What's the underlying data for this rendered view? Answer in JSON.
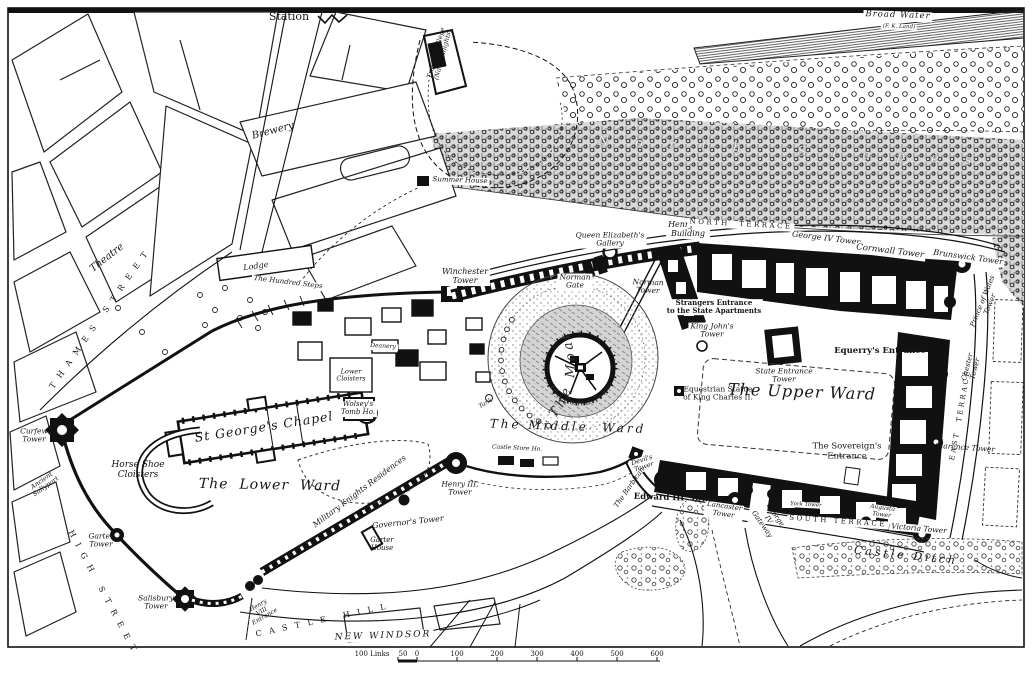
{
  "map": {
    "curved": {
      "the_moat": "The  Moat",
      "round_tower": "The Round Tower"
    },
    "scale_bar": {
      "prefix": "100 Links",
      "half": "50",
      "ticks": [
        "0",
        "100",
        "200",
        "300",
        "400",
        "500",
        "600"
      ]
    },
    "labels": [
      {
        "id": "station",
        "text": "Station",
        "x": 289,
        "y": 17,
        "r": 0,
        "fs": 11,
        "cls": "rm"
      },
      {
        "id": "brewery",
        "text": "Brewery",
        "x": 273,
        "y": 131,
        "r": -15,
        "fs": 10,
        "cls": "it"
      },
      {
        "id": "theatre",
        "text": "Theatre",
        "x": 107,
        "y": 258,
        "r": -38,
        "fs": 10,
        "cls": "it"
      },
      {
        "id": "thames-street",
        "text": "T H A M E S   S T R E E T",
        "x": 100,
        "y": 320,
        "r": -55,
        "fs": 8,
        "cls": "st"
      },
      {
        "id": "high-street",
        "text": "H I G H   S T R E E T",
        "x": 102,
        "y": 592,
        "r": 62,
        "fs": 8,
        "cls": "st"
      },
      {
        "id": "curfew-tower",
        "text": "Curfew\nTower",
        "x": 34,
        "y": 436,
        "r": 0,
        "fs": 7.5,
        "cls": "it"
      },
      {
        "id": "ancient-sallyport",
        "text": "Ancient\nSallyport",
        "x": 44,
        "y": 484,
        "r": -35,
        "fs": 6.5,
        "cls": "it"
      },
      {
        "id": "garter-tower",
        "text": "Garter\nTower",
        "x": 101,
        "y": 541,
        "r": 0,
        "fs": 7.5,
        "cls": "it"
      },
      {
        "id": "salisbury-tower",
        "text": "Salisbury\nTower",
        "x": 156,
        "y": 603,
        "r": 0,
        "fs": 7.5,
        "cls": "it"
      },
      {
        "id": "henry8-entrance",
        "text": "Henry\nVIII\nEntrance",
        "x": 262,
        "y": 612,
        "r": -30,
        "fs": 6,
        "cls": "it"
      },
      {
        "id": "castle-hill",
        "text": "C A S T L E   H I L L",
        "x": 322,
        "y": 621,
        "r": -12,
        "fs": 8,
        "cls": "st"
      },
      {
        "id": "new-windsor",
        "text": "NEW WINDSOR",
        "x": 383,
        "y": 636,
        "r": -2,
        "fs": 9,
        "cls": "sti box"
      },
      {
        "id": "horse-shoe-cloisters",
        "text": "Horse Shoe\nCloisters",
        "x": 138,
        "y": 470,
        "r": 0,
        "fs": 9,
        "cls": "it"
      },
      {
        "id": "lower-ward",
        "text": "The  Lower  Ward",
        "x": 270,
        "y": 486,
        "r": 1,
        "fs": 14,
        "cls": "itb"
      },
      {
        "id": "st-georges-chapel",
        "text": "St George's Chapel",
        "x": 264,
        "y": 427,
        "r": -9,
        "fs": 12.5,
        "cls": "itb"
      },
      {
        "id": "wolsey-tomb-house",
        "text": "Wolsey's\nTomb Ho.",
        "x": 358,
        "y": 409,
        "r": 0,
        "fs": 7,
        "cls": "it box"
      },
      {
        "id": "lower-cloisters",
        "text": "Lower\nCloisters",
        "x": 351,
        "y": 376,
        "r": 0,
        "fs": 6.5,
        "cls": "it"
      },
      {
        "id": "deanery",
        "text": "Deanery",
        "x": 383,
        "y": 347,
        "r": 3,
        "fs": 6,
        "cls": "it box"
      },
      {
        "id": "lodge",
        "text": "Lodge",
        "x": 256,
        "y": 267,
        "r": -8,
        "fs": 8,
        "cls": "it"
      },
      {
        "id": "hundred-steps",
        "text": "The Hundred Steps",
        "x": 288,
        "y": 283,
        "r": 7,
        "fs": 7,
        "cls": "it box"
      },
      {
        "id": "winchester-tower",
        "text": "Winchester\nTower",
        "x": 465,
        "y": 277,
        "r": 0,
        "fs": 8,
        "cls": "it box"
      },
      {
        "id": "queen-elizabeths-gallery",
        "text": "Queen Elizabeth's\nGallery",
        "x": 610,
        "y": 240,
        "r": 0,
        "fs": 7.5,
        "cls": "it box"
      },
      {
        "id": "norman-gate",
        "text": "Norman\nGate",
        "x": 575,
        "y": 282,
        "r": 0,
        "fs": 7.5,
        "cls": "it box"
      },
      {
        "id": "henry7-building",
        "text": "Henry VII\nBuilding",
        "x": 688,
        "y": 230,
        "r": 0,
        "fs": 8,
        "cls": "it box"
      },
      {
        "id": "north-terrace",
        "text": "NORTH  TERRACE",
        "x": 741,
        "y": 225,
        "r": 3,
        "fs": 7,
        "cls": "st box"
      },
      {
        "id": "norman-tower",
        "text": "Norman\nTower",
        "x": 648,
        "y": 287,
        "r": 2,
        "fs": 7.5,
        "cls": "it"
      },
      {
        "id": "strangers-entrance",
        "text": "Strangers Entrance\nto the State Apartments",
        "x": 714,
        "y": 307,
        "r": 0,
        "fs": 7,
        "cls": "rmb box"
      },
      {
        "id": "king-johns-tower",
        "text": "King John's\nTower",
        "x": 712,
        "y": 331,
        "r": 0,
        "fs": 7.5,
        "cls": "it box"
      },
      {
        "id": "george4-tower",
        "text": "George IV Tower",
        "x": 826,
        "y": 239,
        "r": 7,
        "fs": 8,
        "cls": "it box"
      },
      {
        "id": "cornwall-tower",
        "text": "Cornwall Tower",
        "x": 890,
        "y": 252,
        "r": 7,
        "fs": 8.5,
        "cls": "it box"
      },
      {
        "id": "brunswick-tower",
        "text": "Brunswick Tower",
        "x": 968,
        "y": 258,
        "r": 8,
        "fs": 8,
        "cls": "it box"
      },
      {
        "id": "prince-of-wales-tower",
        "text": "Prince of Wales\nTower",
        "x": 987,
        "y": 303,
        "r": -68,
        "fs": 7,
        "cls": "it"
      },
      {
        "id": "chester-tower",
        "text": "Chester\nTower",
        "x": 972,
        "y": 368,
        "r": -76,
        "fs": 7,
        "cls": "it"
      },
      {
        "id": "east-terrace",
        "text": "EAST  TERRACE",
        "x": 961,
        "y": 415,
        "r": -80,
        "fs": 7,
        "cls": "st"
      },
      {
        "id": "equerrys-entrance",
        "text": "Equerry's Entrance",
        "x": 880,
        "y": 352,
        "r": 0,
        "fs": 8.5,
        "cls": "rmb"
      },
      {
        "id": "state-entrance-tower",
        "text": "State Entrance\nTower",
        "x": 784,
        "y": 376,
        "r": 0,
        "fs": 7.5,
        "cls": "it"
      },
      {
        "id": "upper-ward",
        "text": "The Upper Ward",
        "x": 802,
        "y": 392,
        "r": 2,
        "fs": 16,
        "cls": "itb"
      },
      {
        "id": "equestrian-statue",
        "text": "Equestrian Statue\nof King Charles II.",
        "x": 718,
        "y": 394,
        "r": 0,
        "fs": 7.5,
        "cls": "rm"
      },
      {
        "id": "sovereigns-entrance",
        "text": "The Sovereign's\nEntrance",
        "x": 847,
        "y": 452,
        "r": 0,
        "fs": 8.5,
        "cls": "rm"
      },
      {
        "id": "clarence-tower",
        "text": "Clarence Tower",
        "x": 965,
        "y": 448,
        "r": 4,
        "fs": 7.5,
        "cls": "it"
      },
      {
        "id": "south-terrace",
        "text": "SOUTH TERRACE",
        "x": 838,
        "y": 522,
        "r": 4,
        "fs": 7,
        "cls": "st box"
      },
      {
        "id": "york-tower",
        "text": "York Tower",
        "x": 806,
        "y": 505,
        "r": 3,
        "fs": 5.5,
        "cls": "it box"
      },
      {
        "id": "augusta-tower",
        "text": "Augusta\nTower",
        "x": 882,
        "y": 512,
        "r": 8,
        "fs": 6,
        "cls": "it box"
      },
      {
        "id": "victoria-tower",
        "text": "Victoria Tower",
        "x": 919,
        "y": 529,
        "r": 5,
        "fs": 7.5,
        "cls": "it box"
      },
      {
        "id": "castle-ditch",
        "text": "Castle Ditch",
        "x": 906,
        "y": 556,
        "r": 6,
        "fs": 11,
        "cls": "itsp"
      },
      {
        "id": "lancaster-tower",
        "text": "Lancaster\nTower",
        "x": 724,
        "y": 511,
        "r": 8,
        "fs": 7,
        "cls": "it box"
      },
      {
        "id": "george4-gateway",
        "text": "George\nIV\nGateway",
        "x": 768,
        "y": 520,
        "r": 55,
        "fs": 7,
        "cls": "it"
      },
      {
        "id": "edward3-tower",
        "text": "Edward III  Tower",
        "x": 676,
        "y": 499,
        "r": 2,
        "fs": 8.5,
        "cls": "rmb"
      },
      {
        "id": "devils-tower",
        "text": "Devil's\nTower",
        "x": 643,
        "y": 464,
        "r": -18,
        "fs": 6.5,
        "cls": "it box"
      },
      {
        "id": "the-barbican",
        "text": "The Barbican",
        "x": 630,
        "y": 488,
        "r": -55,
        "fs": 7,
        "cls": "it"
      },
      {
        "id": "middle-ward",
        "text": "The Middle  Ward",
        "x": 568,
        "y": 427,
        "r": 2,
        "fs": 12,
        "cls": "itsp"
      },
      {
        "id": "castle-store-house",
        "text": "Castle Store Ho.",
        "x": 517,
        "y": 449,
        "r": 3,
        "fs": 6,
        "cls": "it box"
      },
      {
        "id": "tank",
        "text": "Tank",
        "x": 486,
        "y": 404,
        "r": -30,
        "fs": 6,
        "cls": "it"
      },
      {
        "id": "henry3-tower",
        "text": "Henry III,\nTower",
        "x": 460,
        "y": 489,
        "r": 0,
        "fs": 7.5,
        "cls": "it"
      },
      {
        "id": "governors-tower",
        "text": "Governor's Tower",
        "x": 408,
        "y": 523,
        "r": -6,
        "fs": 8,
        "cls": "it"
      },
      {
        "id": "garter-house",
        "text": "Garter\nHouse",
        "x": 382,
        "y": 545,
        "r": 0,
        "fs": 7,
        "cls": "it"
      },
      {
        "id": "military-knights",
        "text": "Military Knights Residences",
        "x": 360,
        "y": 492,
        "r": -37,
        "fs": 8,
        "cls": "it"
      },
      {
        "id": "broad-water",
        "text": "Broad Water",
        "x": 898,
        "y": 16,
        "r": 2,
        "fs": 8.5,
        "cls": "itb box"
      },
      {
        "id": "broad-water-sub",
        "text": "(F. K. Land)",
        "x": 899,
        "y": 27,
        "r": 2,
        "fs": 5.5,
        "cls": "it box"
      },
      {
        "id": "north-slopes",
        "text": "N o r t h   S l o p e s",
        "x": 790,
        "y": 152,
        "r": 3,
        "fs": 13,
        "cls": "ghost"
      },
      {
        "id": "summer-house",
        "text": "Summer House",
        "x": 460,
        "y": 181,
        "r": 2,
        "fs": 7,
        "cls": "it box"
      },
      {
        "id": "travers-college",
        "text": "Travers College\n(Naval Knights)",
        "x": 440,
        "y": 54,
        "r": -75,
        "fs": 6.5,
        "cls": "it"
      }
    ]
  }
}
